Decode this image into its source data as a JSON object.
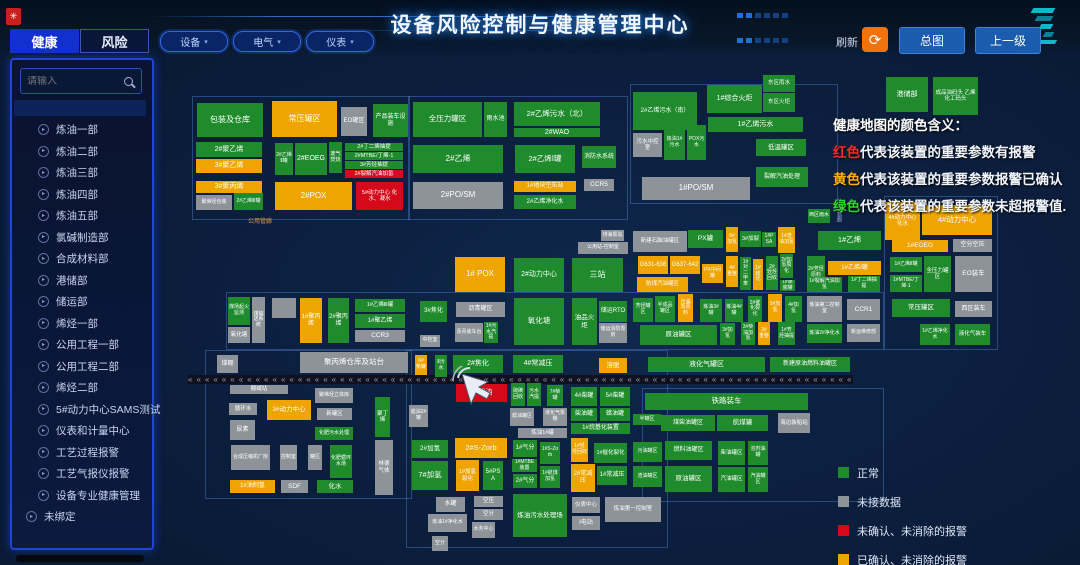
{
  "header": {
    "title": "设备风险控制与健康管理中心"
  },
  "tabs": [
    {
      "label": "健康",
      "active": true
    },
    {
      "label": "风险",
      "active": false
    }
  ],
  "filters": {
    "chevron": "▾",
    "items": [
      {
        "label": "设备"
      },
      {
        "label": "电气"
      },
      {
        "label": "仪表"
      }
    ]
  },
  "toolbar": {
    "refresh_label": "刷新",
    "refresh_icon": "⟳",
    "overview_label": "总图",
    "up_label": "上一级"
  },
  "sidebar": {
    "search_placeholder": "请输入",
    "item_icon": "▸",
    "items": [
      "炼油一部",
      "炼油二部",
      "炼油三部",
      "炼油四部",
      "炼油五部",
      "氯碱制造部",
      "合成材料部",
      "港储部",
      "储运部",
      "烯烃一部",
      "公用工程一部",
      "公用工程二部",
      "烯烃二部",
      "5#动力中心SAMS测试",
      "仪表和计量中心",
      "工艺过程报警",
      "工艺气报仪报警",
      "设备专业健康管理",
      "未绑定"
    ]
  },
  "color_legend": {
    "title": "健康地图的颜色含义：",
    "lines": [
      {
        "word": "红色",
        "color": "#ff2a2a",
        "text": "代表该装置的重要参数有报警"
      },
      {
        "word": "黄色",
        "color": "#ffb300",
        "text": "代表该装置的重要参数报警已确认"
      },
      {
        "word": "绿色",
        "color": "#2ed52e",
        "text": "代表该装置的重要参数未超报警值."
      }
    ]
  },
  "status_legend": [
    {
      "color": "#1f8b2c",
      "label": "正常"
    },
    {
      "color": "#8d9399",
      "label": "未接数据"
    },
    {
      "color": "#d40a1a",
      "label": "未确认、未消除的报警"
    },
    {
      "color": "#efa400",
      "label": "已确认、未消除的报警"
    }
  ],
  "colors": {
    "normal": "#1f8b2c",
    "no_data": "#8d9399",
    "alarm_unack": "#d40a1a",
    "alarm_ack": "#efa400"
  },
  "railway": {
    "char": "«",
    "count": 95
  },
  "road_labels": [
    {
      "text": "公用管廊",
      "x": 248,
      "y": 216,
      "v": false,
      "color": "#e09a3c"
    },
    {
      "text": "公共管廊",
      "x": 834,
      "y": 198,
      "v": true,
      "color": "#8fa8d6"
    }
  ],
  "map_blocks": [
    [
      "包装及仓库",
      197,
      103,
      66,
      34,
      "g",
      8
    ],
    [
      "常压罐区",
      272,
      101,
      65,
      36,
      "o",
      8
    ],
    [
      "EO罐区",
      341,
      107,
      26,
      29,
      "x",
      6
    ],
    [
      "产品装车设施",
      373,
      104,
      35,
      33,
      "g",
      6
    ],
    [
      "2#聚乙烯",
      196,
      142,
      66,
      15,
      "g",
      7
    ],
    [
      "3#聚乙烯",
      196,
      159,
      66,
      14,
      "o",
      7
    ],
    [
      "2#乙烯Ⅱ罐",
      275,
      143,
      18,
      32,
      "g",
      5
    ],
    [
      "2#EOEG",
      295,
      143,
      32,
      32,
      "g",
      7
    ],
    [
      "废气焚烧",
      329,
      142,
      13,
      31,
      "g",
      5
    ],
    [
      "2#丁二烯抽提",
      345,
      143,
      58,
      8,
      "g",
      5.5
    ],
    [
      "2#MTBE/丁烯-1",
      345,
      152,
      58,
      8,
      "g",
      5.5
    ],
    [
      "3#芳烃抽提",
      345,
      161,
      58,
      8,
      "g",
      5.5
    ],
    [
      "2#裂解汽油加氢",
      345,
      170,
      58,
      8,
      "r",
      5.5
    ],
    [
      "3#聚丙烯",
      196,
      181,
      66,
      12,
      "o",
      7
    ],
    [
      "聚烯烃包装",
      196,
      195,
      36,
      15,
      "x",
      5
    ],
    [
      "2#乙烯Ⅲ罐",
      234,
      193,
      29,
      17,
      "g",
      5
    ],
    [
      "2#POX",
      275,
      182,
      77,
      28,
      "o",
      8
    ],
    [
      "5#动力中心 化水、凝水",
      356,
      182,
      47,
      28,
      "r",
      5.5
    ],
    [
      "全压力罐区",
      413,
      102,
      69,
      35,
      "g",
      7.5
    ],
    [
      "雨水池",
      484,
      102,
      23,
      35,
      "g",
      6
    ],
    [
      "2#乙烯污水（北）",
      514,
      102,
      86,
      24,
      "g",
      7.5
    ],
    [
      "2#WAO",
      514,
      128,
      86,
      9,
      "g",
      7
    ],
    [
      "2#乙烯",
      413,
      145,
      90,
      28,
      "g",
      8
    ],
    [
      "2#乙烯Ⅰ罐",
      515,
      145,
      60,
      28,
      "g",
      7.5
    ],
    [
      "消防水系统",
      582,
      146,
      34,
      22,
      "g",
      6
    ],
    [
      "1#地块空压站",
      514,
      181,
      62,
      11,
      "o",
      6
    ],
    [
      "CCR5",
      584,
      179,
      30,
      12,
      "x",
      6.5
    ],
    [
      "2#PO/SM",
      413,
      182,
      90,
      27,
      "x",
      8
    ],
    [
      "2#乙烯净化水",
      514,
      195,
      62,
      14,
      "g",
      6
    ],
    [
      "2#乙烯污水（南）",
      633,
      92,
      64,
      38,
      "g",
      6
    ],
    [
      "污水中控室",
      633,
      133,
      29,
      24,
      "x",
      5.5
    ],
    [
      "炼油1#污水",
      664,
      125,
      21,
      35,
      "g",
      5
    ],
    [
      "POX污水",
      687,
      125,
      19,
      35,
      "g",
      5
    ],
    [
      "1#综合火炬",
      707,
      85,
      55,
      28,
      "g",
      7
    ],
    [
      "东区雨水",
      763,
      75,
      32,
      17,
      "g",
      5.5
    ],
    [
      "东区火炬",
      763,
      93,
      32,
      19,
      "g",
      5.5
    ],
    [
      "1#乙烯污水",
      708,
      117,
      95,
      15,
      "g",
      7
    ],
    [
      "低温罐区",
      756,
      139,
      50,
      17,
      "g",
      6.5
    ],
    [
      "裂解汽油处理",
      756,
      167,
      52,
      20,
      "g",
      6
    ],
    [
      "1#PO/SM",
      642,
      177,
      108,
      23,
      "x",
      8
    ],
    [
      "西区雨水",
      808,
      209,
      22,
      14,
      "g",
      5
    ],
    [
      "港储部",
      886,
      77,
      42,
      35,
      "g",
      7
    ],
    [
      "成品油码头 乙烯化工码头",
      933,
      77,
      45,
      38,
      "g",
      5.5
    ],
    [
      "煤场起火监测",
      228,
      297,
      22,
      28,
      "g",
      5
    ],
    [
      "氧化塘",
      228,
      327,
      22,
      16,
      "x",
      5.5
    ],
    [
      "煤输送系统",
      252,
      297,
      13,
      46,
      "x",
      5
    ],
    [
      "",
      272,
      298,
      24,
      20,
      "x",
      5
    ],
    [
      "1#聚丙烯",
      300,
      298,
      22,
      45,
      "o",
      6
    ],
    [
      "2#聚丙烯",
      328,
      298,
      21,
      45,
      "g",
      6
    ],
    [
      "1#乙烯Ⅲ罐",
      355,
      299,
      50,
      13,
      "g",
      5.5
    ],
    [
      "1#聚乙烯",
      355,
      314,
      50,
      14,
      "g",
      6
    ],
    [
      "CCR3",
      355,
      330,
      50,
      12,
      "x",
      6.5
    ],
    [
      "3#焦化",
      420,
      301,
      27,
      21,
      "g",
      6
    ],
    [
      "中控室",
      420,
      335,
      20,
      12,
      "x",
      5
    ],
    [
      "1# POX",
      455,
      257,
      50,
      35,
      "o",
      8
    ],
    [
      "2#动力中心",
      514,
      258,
      50,
      34,
      "g",
      7
    ],
    [
      "三站",
      572,
      258,
      51,
      34,
      "g",
      8
    ],
    [
      "排海泵站",
      601,
      230,
      23,
      11,
      "x",
      5
    ],
    [
      "公用站-控制室",
      578,
      242,
      50,
      12,
      "x",
      5
    ],
    [
      "新建石脑油罐区",
      633,
      231,
      54,
      21,
      "x",
      5.5
    ],
    [
      "G631-636",
      638,
      256,
      30,
      18,
      "o",
      6
    ],
    [
      "G637-642",
      670,
      256,
      30,
      18,
      "o",
      6
    ],
    [
      "航煤汽油罐区",
      637,
      277,
      51,
      15,
      "o",
      5.5
    ],
    [
      "PX罐",
      688,
      230,
      35,
      18,
      "g",
      6.5
    ],
    [
      "6#加氢",
      726,
      227,
      12,
      25,
      "o",
      5
    ],
    [
      "3#加裂",
      740,
      231,
      21,
      16,
      "g",
      5.5
    ],
    [
      "1#PSA",
      762,
      232,
      14,
      15,
      "g",
      5
    ],
    [
      "1#渣油加氢",
      778,
      227,
      17,
      26,
      "o",
      5
    ],
    [
      "1#乙烯",
      818,
      231,
      63,
      19,
      "g",
      7.5
    ],
    [
      "PX中间罐",
      702,
      264,
      21,
      19,
      "o",
      5
    ],
    [
      "4#重整",
      726,
      256,
      12,
      31,
      "o",
      5
    ],
    [
      "1#对二甲苯",
      740,
      257,
      11,
      33,
      "g",
      5
    ],
    [
      "1#歧化",
      753,
      259,
      10,
      31,
      "o",
      5
    ],
    [
      "2#轻烃回收",
      766,
      256,
      12,
      34,
      "g",
      5
    ],
    [
      "2#加氢裂化",
      780,
      254,
      13,
      24,
      "g",
      5
    ],
    [
      "1#承装罐",
      780,
      280,
      15,
      11,
      "g",
      5
    ],
    [
      "2#芳烃原料",
      807,
      256,
      18,
      34,
      "g",
      5
    ],
    [
      "1#乙烯Ⅰ罐",
      828,
      261,
      53,
      14,
      "o",
      6
    ],
    [
      "1#裂解汽油加氢",
      807,
      277,
      35,
      15,
      "g",
      5
    ],
    [
      "1#丁二烯抽提",
      848,
      276,
      32,
      16,
      "g",
      5
    ],
    [
      "半成品罐区",
      655,
      296,
      20,
      26,
      "g",
      5
    ],
    [
      "污油泵原料",
      678,
      294,
      15,
      28,
      "o",
      5
    ],
    [
      "炼油3#罐",
      700,
      299,
      22,
      23,
      "g",
      5
    ],
    [
      "炼油4#罐",
      725,
      299,
      18,
      23,
      "g",
      5
    ],
    [
      "2#催化裂化",
      748,
      296,
      14,
      26,
      "g",
      5
    ],
    [
      "5#加氢",
      768,
      294,
      14,
      28,
      "o",
      5
    ],
    [
      "4#加氢",
      785,
      296,
      17,
      26,
      "g",
      5
    ],
    [
      "炼油第二控制室",
      807,
      296,
      35,
      26,
      "x",
      5
    ],
    [
      "CCR1",
      847,
      299,
      33,
      21,
      "x",
      6.5
    ],
    [
      "原油罐区",
      640,
      325,
      77,
      20,
      "g",
      6.5
    ],
    [
      "3#加氢",
      720,
      323,
      15,
      22,
      "g",
      5
    ],
    [
      "3#柴油加氢",
      741,
      322,
      14,
      23,
      "g",
      5
    ],
    [
      "3#重整",
      758,
      322,
      12,
      23,
      "o",
      5
    ],
    [
      "1#芳烃抽提",
      778,
      322,
      17,
      23,
      "g",
      5
    ],
    [
      "炼油2#净化水",
      807,
      324,
      35,
      19,
      "g",
      5
    ],
    [
      "新运维修部",
      847,
      324,
      33,
      18,
      "x",
      5
    ],
    [
      "沥青罐区",
      456,
      302,
      49,
      15,
      "x",
      6
    ],
    [
      "沥青装车台",
      455,
      323,
      28,
      19,
      "x",
      5
    ],
    [
      "1#污水汽提",
      484,
      322,
      14,
      21,
      "g",
      5
    ],
    [
      "氧化塘",
      514,
      298,
      50,
      47,
      "g",
      7.5
    ],
    [
      "油品火炬",
      572,
      298,
      25,
      47,
      "g",
      6.5
    ],
    [
      "储运RTO",
      599,
      301,
      28,
      21,
      "g",
      6
    ],
    [
      "储运消防泵房",
      599,
      323,
      28,
      20,
      "x",
      5
    ],
    [
      "芳烃罐区",
      633,
      298,
      20,
      24,
      "g",
      5
    ],
    [
      "煤棚",
      217,
      355,
      21,
      18,
      "x",
      6
    ],
    [
      "聚丙烯仓库及站台",
      300,
      352,
      108,
      21,
      "x",
      7.5
    ],
    [
      "酸碱站",
      230,
      385,
      58,
      9,
      "x",
      5.5
    ],
    [
      "循环水",
      229,
      403,
      28,
      12,
      "x",
      5.5
    ],
    [
      "3#动力中心",
      267,
      400,
      44,
      20,
      "o",
      6.5
    ],
    [
      "聚烯烃立体库",
      315,
      388,
      38,
      15,
      "x",
      5
    ],
    [
      "新罐区",
      317,
      408,
      35,
      12,
      "x",
      5.5
    ],
    [
      "尿素",
      230,
      420,
      25,
      20,
      "x",
      6
    ],
    [
      "化肥污水处理",
      315,
      427,
      38,
      13,
      "g",
      5
    ],
    [
      "合成压缩机厂房",
      231,
      445,
      39,
      25,
      "x",
      5
    ],
    [
      "控制室",
      280,
      445,
      17,
      25,
      "x",
      5
    ],
    [
      "罐区",
      308,
      445,
      14,
      25,
      "x",
      5
    ],
    [
      "化肥循环水场",
      330,
      445,
      22,
      33,
      "g",
      5
    ],
    [
      "1#油制氢",
      230,
      480,
      45,
      13,
      "o",
      6
    ],
    [
      "SDF",
      281,
      480,
      27,
      13,
      "x",
      6.5
    ],
    [
      "化水",
      317,
      480,
      36,
      13,
      "g",
      6.5
    ],
    [
      "聚丁烯",
      375,
      397,
      15,
      40,
      "g",
      5.5
    ],
    [
      "林德气体",
      375,
      440,
      18,
      55,
      "x",
      5.5
    ],
    [
      "6#柴罐",
      415,
      355,
      12,
      20,
      "o",
      5
    ],
    [
      "Ⅱ污水",
      435,
      355,
      12,
      22,
      "g",
      5
    ],
    [
      "2#焦化",
      453,
      355,
      50,
      18,
      "g",
      7
    ],
    [
      "4#常减压",
      513,
      355,
      50,
      18,
      "g",
      7
    ],
    [
      "溶脱",
      599,
      358,
      28,
      15,
      "o",
      6.5
    ],
    [
      "8#蜡油",
      456,
      384,
      51,
      18,
      "r",
      7
    ],
    [
      "蜡油2#罐",
      409,
      405,
      19,
      22,
      "x",
      5
    ],
    [
      "硫磺回收",
      511,
      383,
      14,
      23,
      "g",
      5
    ],
    [
      "污水汽提",
      527,
      383,
      14,
      23,
      "g",
      5
    ],
    [
      "7#柴罐",
      547,
      385,
      16,
      21,
      "g",
      5
    ],
    [
      "蜡油罐区",
      510,
      408,
      24,
      18,
      "x",
      5
    ],
    [
      "液化气泵棚",
      543,
      408,
      24,
      18,
      "x",
      5
    ],
    [
      "炼油1#罐",
      518,
      428,
      49,
      10,
      "x",
      5.5
    ],
    [
      "4#柴罐",
      571,
      387,
      26,
      19,
      "g",
      6
    ],
    [
      "5#柴罐",
      600,
      387,
      30,
      19,
      "g",
      6
    ],
    [
      "柴油罐",
      571,
      408,
      26,
      13,
      "g",
      6
    ],
    [
      "蜡油罐",
      600,
      408,
      30,
      13,
      "g",
      6
    ],
    [
      "1#烷基化装置",
      571,
      423,
      59,
      11,
      "g",
      6
    ],
    [
      "半罐区",
      633,
      414,
      28,
      11,
      "g",
      5
    ],
    [
      "煤柴油罐区",
      661,
      415,
      54,
      16,
      "g",
      6
    ],
    [
      "航煤罐",
      717,
      415,
      51,
      16,
      "g",
      6.5
    ],
    [
      "海边装船站",
      778,
      413,
      32,
      20,
      "x",
      5.5
    ],
    [
      "铁路装车",
      645,
      393,
      163,
      17,
      "g",
      7.5
    ],
    [
      "液化气罐区",
      648,
      357,
      117,
      15,
      "g",
      7
    ],
    [
      "新建原油燃料油罐区",
      770,
      357,
      80,
      15,
      "g",
      6
    ],
    [
      "2#加氢",
      412,
      440,
      36,
      18,
      "g",
      6.5
    ],
    [
      "2#S-Zorb",
      455,
      438,
      52,
      20,
      "o",
      7.5
    ],
    [
      "7#加氢",
      412,
      461,
      36,
      29,
      "g",
      7.5
    ],
    [
      "1#加氢裂化",
      456,
      460,
      23,
      31,
      "o",
      5.5
    ],
    [
      "5#PSA",
      483,
      461,
      20,
      29,
      "g",
      6
    ],
    [
      "1#气分",
      513,
      440,
      24,
      17,
      "g",
      6
    ],
    [
      "1#S-Zorb",
      540,
      442,
      20,
      22,
      "g",
      5
    ],
    [
      "1#MTBE装置",
      512,
      459,
      25,
      13,
      "g",
      5
    ],
    [
      "2#气分",
      513,
      474,
      24,
      14,
      "g",
      6
    ],
    [
      "1#航煤加氢",
      540,
      466,
      20,
      22,
      "g",
      5
    ],
    [
      "1#轻烃回收",
      571,
      438,
      17,
      24,
      "o",
      5
    ],
    [
      "1#催化裂化",
      594,
      443,
      33,
      20,
      "g",
      5.5
    ],
    [
      "2#常减压",
      571,
      464,
      24,
      28,
      "o",
      6
    ],
    [
      "1#常减压",
      597,
      466,
      30,
      19,
      "g",
      6
    ],
    [
      "污油罐区",
      633,
      442,
      29,
      20,
      "g",
      5
    ],
    [
      "渣油罐区",
      633,
      466,
      29,
      21,
      "g",
      5
    ],
    [
      "水罐",
      436,
      497,
      29,
      15,
      "x",
      6
    ],
    [
      "空压",
      474,
      496,
      29,
      11,
      "x",
      5.5
    ],
    [
      "空分",
      474,
      509,
      29,
      11,
      "x",
      5.5
    ],
    [
      "炼油1#净化水",
      428,
      514,
      39,
      18,
      "x",
      5
    ],
    [
      "水务中心",
      472,
      522,
      23,
      16,
      "x",
      5
    ],
    [
      "空分",
      432,
      536,
      16,
      15,
      "x",
      5
    ],
    [
      "炼油污水处理场",
      513,
      494,
      54,
      43,
      "g",
      6.5
    ],
    [
      "仪表中心",
      572,
      497,
      28,
      16,
      "x",
      5.5
    ],
    [
      "Ⅰ电站",
      572,
      516,
      28,
      14,
      "x",
      6
    ],
    [
      "炼油第一控制室",
      605,
      497,
      56,
      25,
      "x",
      5.5
    ],
    [
      "燃料油罐区",
      665,
      441,
      47,
      19,
      "g",
      6
    ],
    [
      "柴油罐区",
      718,
      441,
      27,
      24,
      "g",
      5.5
    ],
    [
      "溶剂油罐",
      748,
      441,
      20,
      24,
      "g",
      5
    ],
    [
      "原油罐区",
      665,
      466,
      47,
      26,
      "g",
      6.5
    ],
    [
      "汽油罐区",
      718,
      467,
      27,
      25,
      "g",
      5.5
    ],
    [
      "汽油罐区",
      748,
      467,
      20,
      25,
      "g",
      5
    ],
    [
      "4#动力中心化水",
      885,
      202,
      35,
      38,
      "o",
      5.5
    ],
    [
      "4#动力中心",
      922,
      205,
      70,
      30,
      "o",
      7.5
    ],
    [
      "1#EOEG",
      892,
      240,
      56,
      12,
      "o",
      6.5
    ],
    [
      "空分空压",
      953,
      239,
      39,
      13,
      "x",
      6
    ],
    [
      "1#乙烯Ⅱ罐",
      890,
      257,
      32,
      15,
      "g",
      5
    ],
    [
      "全压力罐区",
      924,
      256,
      27,
      36,
      "g",
      5.5
    ],
    [
      "EO装车",
      955,
      256,
      37,
      36,
      "x",
      6.5
    ],
    [
      "1#MTBE/丁烯-1",
      890,
      275,
      32,
      17,
      "g",
      5
    ],
    [
      "常压罐区",
      892,
      299,
      58,
      18,
      "g",
      6.5
    ],
    [
      "西区装车",
      955,
      301,
      37,
      16,
      "x",
      6
    ],
    [
      "1#乙烯净化水",
      920,
      324,
      30,
      21,
      "g",
      5
    ],
    [
      "液化气装车",
      955,
      324,
      35,
      21,
      "g",
      5.5
    ]
  ]
}
